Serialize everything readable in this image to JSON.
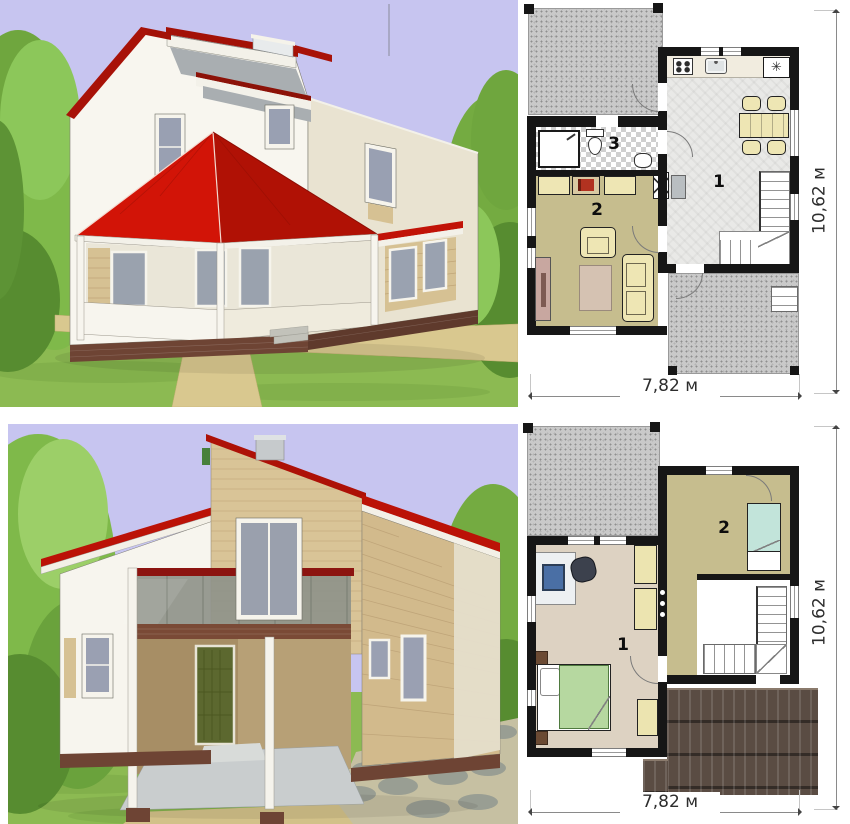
{
  "first_floor_plan": {
    "rooms": [
      {
        "number": "1"
      },
      {
        "number": "2"
      },
      {
        "number": "3"
      }
    ],
    "width_dimension": "7,82 м",
    "height_dimension": "10,62 м",
    "fridge_symbol": "✳"
  },
  "second_floor_plan": {
    "rooms": [
      {
        "number": "1"
      },
      {
        "number": "2"
      }
    ],
    "width_dimension": "7,82 м",
    "height_dimension": "10,62 м"
  },
  "palette": {
    "sky": "#c7c5f0",
    "grass": "#8cba52",
    "roof_red": "#cc1507",
    "wood_siding": "#d6c193",
    "wall_white": "#f7f5ee",
    "brick_base": "#6e4434",
    "plan_wall_black": "#161616",
    "terrace_gray": "#c9c9c9",
    "living_floor_olive": "#c6bd8e",
    "bedroom_floor_beige": "#ddd2c2",
    "furniture_yellow": "#eee6b4",
    "roof_tile_brown": "#5a4c43",
    "bed_green": "#b6d8a0",
    "bed_blue": "#c2e4da"
  }
}
